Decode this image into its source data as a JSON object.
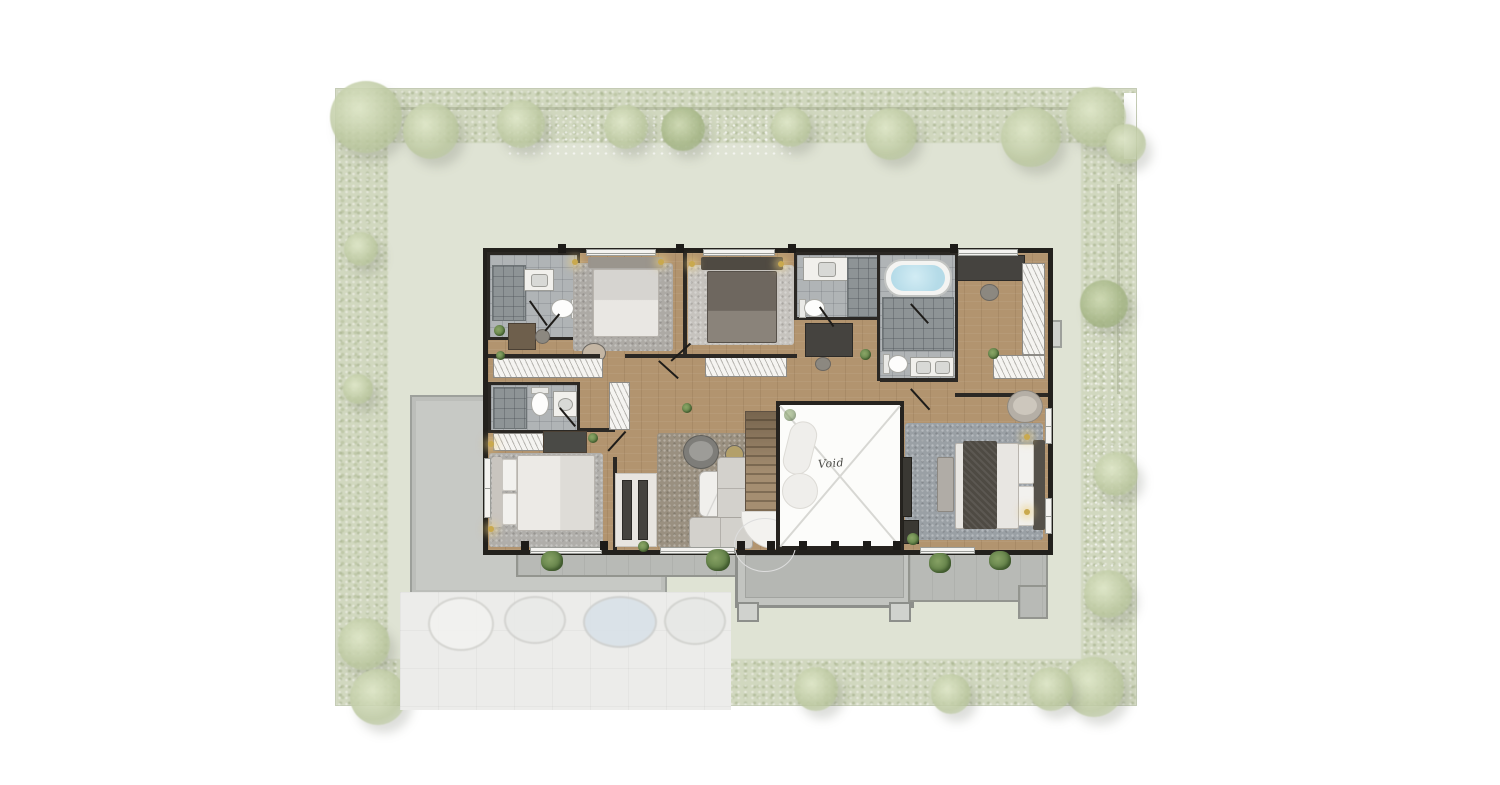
{
  "labels": {
    "void": "Void"
  },
  "palette": {
    "yard_green": "#dfe3d4",
    "hedge_green": "#c1cba7",
    "wood_floor": "#b2946f",
    "bath_tile": "#b0b4b6",
    "wall": "#26231f",
    "slab_grey": "#c7c9c5",
    "driveway_grey": "#ececea",
    "balcony_grey": "#b8bab6",
    "tub_water_blue": "#b5dbe8",
    "plant_green": "#5f7f46",
    "sconce_gold": "#c9a94e",
    "void_white": "#fcfcfa"
  },
  "decor": {
    "trees": [
      [
        30,
        28,
        36,
        0
      ],
      [
        95,
        42,
        28,
        0
      ],
      [
        185,
        35,
        24,
        0
      ],
      [
        290,
        38,
        22,
        0
      ],
      [
        347,
        40,
        22,
        1
      ],
      [
        455,
        38,
        20,
        0
      ],
      [
        555,
        45,
        26,
        0
      ],
      [
        695,
        48,
        30,
        0
      ],
      [
        760,
        28,
        30,
        0
      ],
      [
        790,
        55,
        20,
        0
      ],
      [
        768,
        215,
        24,
        1
      ],
      [
        780,
        385,
        22,
        0
      ],
      [
        772,
        505,
        24,
        0
      ],
      [
        758,
        598,
        30,
        0
      ],
      [
        25,
        160,
        17,
        0
      ],
      [
        22,
        300,
        15,
        0
      ],
      [
        28,
        555,
        26,
        0
      ],
      [
        42,
        608,
        28,
        0
      ],
      [
        480,
        600,
        22,
        0
      ],
      [
        615,
        605,
        20,
        0
      ],
      [
        715,
        600,
        22,
        0
      ]
    ],
    "sconces": [
      [
        575,
        262
      ],
      [
        661,
        262
      ],
      [
        692,
        264
      ],
      [
        781,
        264
      ],
      [
        491,
        444
      ],
      [
        491,
        529
      ],
      [
        1027,
        437
      ],
      [
        1027,
        512
      ]
    ],
    "planters": [
      [
        541,
        551,
        22,
        20
      ],
      [
        706,
        549,
        24,
        22
      ],
      [
        929,
        553,
        22,
        20
      ],
      [
        989,
        551,
        22,
        19
      ]
    ],
    "door_tabs": {
      "top": {
        "y": 244,
        "x": [
          558,
          676,
          788,
          950
        ]
      },
      "bottom": {
        "y": 541,
        "x": [
          521,
          600,
          737,
          767,
          799,
          831,
          863,
          893
        ]
      }
    },
    "ghost_cars": [
      [
        428,
        597,
        62,
        50,
        "#f3f3f1"
      ],
      [
        504,
        596,
        58,
        44,
        "#e9eae8"
      ],
      [
        583,
        596,
        70,
        48,
        "#d8e1e8"
      ],
      [
        664,
        597,
        58,
        44,
        "#e7e8e6"
      ]
    ],
    "door_swings": [
      [
        530,
        300,
        30,
        55
      ],
      [
        545,
        330,
        22,
        -50
      ],
      [
        560,
        407,
        24,
        50
      ],
      [
        608,
        450,
        26,
        -48
      ],
      [
        659,
        360,
        26,
        42
      ],
      [
        671,
        360,
        26,
        -42
      ],
      [
        820,
        306,
        24,
        55
      ],
      [
        911,
        303,
        26,
        48
      ],
      [
        911,
        388,
        28,
        48
      ]
    ]
  }
}
